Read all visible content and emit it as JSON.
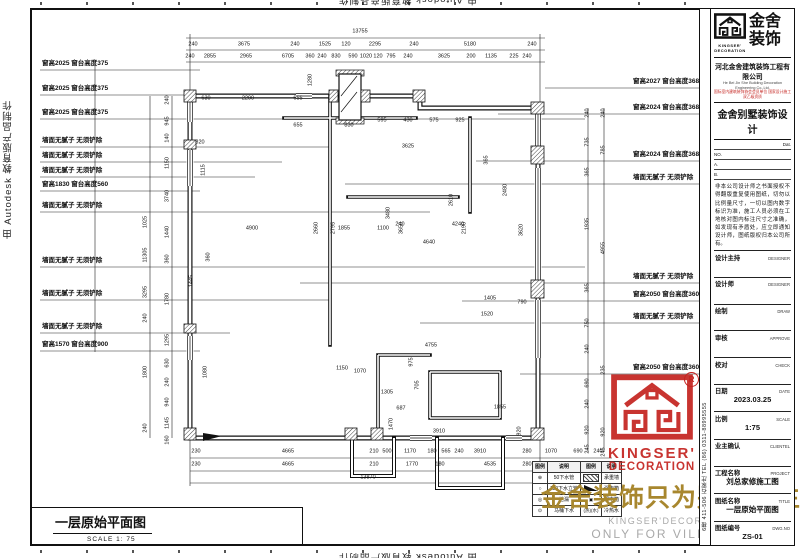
{
  "sheet": {
    "autodesk_side_text": "由 Autodesk 教育版产品制作",
    "autodesk_top_text": "由 Autodesk 教育版产品制作",
    "autodesk_bottom_text": "由 Autodesk 教育版产品制作"
  },
  "title_box": {
    "title": "一层原始平面图",
    "scale": "SCALE 1: 75"
  },
  "watermark": {
    "cn": "金舍装饰只为别墅而生。",
    "en1": "KINGSER'DECORATION",
    "en2": "ONLY FOR VILLA LIFE"
  },
  "stamp": {
    "brand1": "KINGSER'",
    "brand2": "DECORATION",
    "reg": "R"
  },
  "left_labels": [
    {
      "text": "窗高2025 窗台高度375",
      "y": 70,
      "to": 200
    },
    {
      "text": "窗高2025 窗台高度375",
      "y": 95,
      "to": 230
    },
    {
      "text": "窗高2025 窗台高度375",
      "y": 119,
      "to": 585
    },
    {
      "text": "墙面无腻子 无须铲除",
      "y": 147,
      "to": 330
    },
    {
      "text": "墙面无腻子 无须铲除",
      "y": 162,
      "to": 282
    },
    {
      "text": "墙面无腻子 无须铲除",
      "y": 177,
      "to": 255
    },
    {
      "text": "窗高1830 窗台高度560",
      "y": 191,
      "to": 200
    },
    {
      "text": "墙面无腻子 无须铲除",
      "y": 212,
      "to": 430
    },
    {
      "text": "墙面无腻子 无须铲除",
      "y": 267,
      "to": 585
    },
    {
      "text": "墙面无腻子 无须铲除",
      "y": 300,
      "to": 330
    },
    {
      "text": "墙面无腻子 无须铲除",
      "y": 333,
      "to": 230
    },
    {
      "text": "窗高1570 窗台高度900",
      "y": 351,
      "to": 200
    }
  ],
  "right_labels": [
    {
      "text": "窗高2027 窗台高度368",
      "y": 88,
      "from": 545
    },
    {
      "text": "窗高2024 窗台高度368",
      "y": 114,
      "from": 498
    },
    {
      "text": "窗高2024 窗台高度368",
      "y": 161,
      "from": 476
    },
    {
      "text": "墙面无腻子 无须铲除",
      "y": 184,
      "from": 345
    },
    {
      "text": "墙面无腻子 无须铲除",
      "y": 283,
      "from": 300
    },
    {
      "text": "窗高2050 窗台高度360",
      "y": 301,
      "from": 462
    },
    {
      "text": "墙面无腻子 无须铲除",
      "y": 323,
      "from": 420
    },
    {
      "text": "窗高2050 窗台高度360",
      "y": 374,
      "from": 520
    }
  ],
  "dims": {
    "top_total": [
      {
        "t": "13755",
        "x": 360,
        "y": 32
      }
    ],
    "top_row1": [
      {
        "t": "240",
        "x": 193,
        "y": 45
      },
      {
        "t": "3675",
        "x": 244,
        "y": 45
      },
      {
        "t": "240",
        "x": 295,
        "y": 45
      },
      {
        "t": "1525",
        "x": 325,
        "y": 45
      },
      {
        "t": "120",
        "x": 346,
        "y": 45
      },
      {
        "t": "2295",
        "x": 375,
        "y": 45
      },
      {
        "t": "240",
        "x": 414,
        "y": 45
      },
      {
        "t": "5180",
        "x": 470,
        "y": 45
      },
      {
        "t": "240",
        "x": 532,
        "y": 45
      }
    ],
    "top_row2": [
      {
        "t": "240",
        "x": 190,
        "y": 57
      },
      {
        "t": "2855",
        "x": 210,
        "y": 57
      },
      {
        "t": "2965",
        "x": 246,
        "y": 57
      },
      {
        "t": "6705",
        "x": 288,
        "y": 57
      },
      {
        "t": "360",
        "x": 310,
        "y": 57
      },
      {
        "t": "240",
        "x": 322,
        "y": 57
      },
      {
        "t": "830",
        "x": 336,
        "y": 57
      },
      {
        "t": "590",
        "x": 353,
        "y": 57
      },
      {
        "t": "1020",
        "x": 366,
        "y": 57
      },
      {
        "t": "120",
        "x": 378,
        "y": 57
      },
      {
        "t": "795",
        "x": 391,
        "y": 57
      },
      {
        "t": "240",
        "x": 408,
        "y": 57
      },
      {
        "t": "3625",
        "x": 444,
        "y": 57
      },
      {
        "t": "200",
        "x": 471,
        "y": 57
      },
      {
        "t": "1135",
        "x": 491,
        "y": 57
      },
      {
        "t": "225",
        "x": 514,
        "y": 57
      },
      {
        "t": "240",
        "x": 527,
        "y": 57
      }
    ],
    "bottom_row1": [
      {
        "t": "230",
        "x": 196,
        "y": 452
      },
      {
        "t": "4665",
        "x": 288,
        "y": 452
      },
      {
        "t": "210",
        "x": 374,
        "y": 452
      },
      {
        "t": "500",
        "x": 387,
        "y": 452
      },
      {
        "t": "1170",
        "x": 410,
        "y": 452
      },
      {
        "t": "180",
        "x": 432,
        "y": 452
      },
      {
        "t": "565",
        "x": 446,
        "y": 452
      },
      {
        "t": "240",
        "x": 459,
        "y": 452
      },
      {
        "t": "3910",
        "x": 480,
        "y": 452
      },
      {
        "t": "280",
        "x": 527,
        "y": 452
      },
      {
        "t": "1070",
        "x": 551,
        "y": 452
      },
      {
        "t": "690",
        "x": 578,
        "y": 452
      },
      {
        "t": "240",
        "x": 598,
        "y": 452
      }
    ],
    "bottom_row2": [
      {
        "t": "230",
        "x": 196,
        "y": 465
      },
      {
        "t": "4665",
        "x": 288,
        "y": 465
      },
      {
        "t": "210",
        "x": 374,
        "y": 465
      },
      {
        "t": "1770",
        "x": 412,
        "y": 465
      },
      {
        "t": "180",
        "x": 440,
        "y": 465
      },
      {
        "t": "4535",
        "x": 490,
        "y": 465
      },
      {
        "t": "280",
        "x": 527,
        "y": 465
      },
      {
        "t": "1760",
        "x": 553,
        "y": 465
      }
    ],
    "bottom_total": [
      {
        "t": "13870",
        "x": 368,
        "y": 478
      }
    ],
    "left_colA": [
      {
        "t": "1025",
        "x": 146,
        "y": 222,
        "v": 1
      },
      {
        "t": "11305",
        "x": 146,
        "y": 255,
        "v": 1
      },
      {
        "t": "3295",
        "x": 146,
        "y": 292,
        "v": 1
      },
      {
        "t": "240",
        "x": 146,
        "y": 318,
        "v": 1
      },
      {
        "t": "1800",
        "x": 146,
        "y": 372,
        "v": 1
      },
      {
        "t": "240",
        "x": 146,
        "y": 428,
        "v": 1
      }
    ],
    "left_colB": [
      {
        "t": "240",
        "x": 168,
        "y": 100,
        "v": 1
      },
      {
        "t": "945",
        "x": 168,
        "y": 121,
        "v": 1
      },
      {
        "t": "140",
        "x": 168,
        "y": 138,
        "v": 1
      },
      {
        "t": "1150",
        "x": 168,
        "y": 163,
        "v": 1
      },
      {
        "t": "3740",
        "x": 168,
        "y": 196,
        "v": 1
      },
      {
        "t": "1440",
        "x": 168,
        "y": 232,
        "v": 1
      },
      {
        "t": "360",
        "x": 168,
        "y": 259,
        "v": 1
      },
      {
        "t": "1780",
        "x": 168,
        "y": 299,
        "v": 1
      },
      {
        "t": "1295",
        "x": 168,
        "y": 340,
        "v": 1
      },
      {
        "t": "630",
        "x": 168,
        "y": 363,
        "v": 1
      },
      {
        "t": "240",
        "x": 168,
        "y": 382,
        "v": 1
      },
      {
        "t": "940",
        "x": 168,
        "y": 402,
        "v": 1
      },
      {
        "t": "1145",
        "x": 168,
        "y": 423,
        "v": 1
      },
      {
        "t": "160",
        "x": 168,
        "y": 440,
        "v": 1
      }
    ],
    "right_colA": [
      {
        "t": "240",
        "x": 588,
        "y": 113,
        "v": 1
      },
      {
        "t": "735",
        "x": 588,
        "y": 142,
        "v": 1
      },
      {
        "t": "365",
        "x": 588,
        "y": 172,
        "v": 1
      },
      {
        "t": "1935",
        "x": 588,
        "y": 224,
        "v": 1
      },
      {
        "t": "365",
        "x": 588,
        "y": 288,
        "v": 1
      },
      {
        "t": "750",
        "x": 588,
        "y": 323,
        "v": 1
      },
      {
        "t": "240",
        "x": 588,
        "y": 349,
        "v": 1
      },
      {
        "t": "690",
        "x": 588,
        "y": 383,
        "v": 1
      },
      {
        "t": "240",
        "x": 588,
        "y": 404,
        "v": 1
      },
      {
        "t": "920",
        "x": 588,
        "y": 430,
        "v": 1
      },
      {
        "t": "245",
        "x": 588,
        "y": 449,
        "v": 1
      }
    ],
    "right_colB": [
      {
        "t": "240",
        "x": 604,
        "y": 113,
        "v": 1
      },
      {
        "t": "785",
        "x": 604,
        "y": 150,
        "v": 1
      },
      {
        "t": "4955",
        "x": 604,
        "y": 248,
        "v": 1
      },
      {
        "t": "235",
        "x": 604,
        "y": 370,
        "v": 1
      },
      {
        "t": "920",
        "x": 604,
        "y": 432,
        "v": 1
      },
      {
        "t": "245",
        "x": 604,
        "y": 452,
        "v": 1
      }
    ],
    "plan": [
      {
        "t": "630",
        "x": 206,
        "y": 99
      },
      {
        "t": "2290",
        "x": 248,
        "y": 99
      },
      {
        "t": "655",
        "x": 298,
        "y": 99
      },
      {
        "t": "655",
        "x": 298,
        "y": 126
      },
      {
        "t": "830",
        "x": 349,
        "y": 126
      },
      {
        "t": "595",
        "x": 382,
        "y": 121
      },
      {
        "t": "430",
        "x": 408,
        "y": 121
      },
      {
        "t": "575",
        "x": 434,
        "y": 121
      },
      {
        "t": "925",
        "x": 460,
        "y": 121
      },
      {
        "t": "3625",
        "x": 408,
        "y": 147
      },
      {
        "t": "820",
        "x": 200,
        "y": 143
      },
      {
        "t": "1115",
        "x": 204,
        "y": 170,
        "v": 1
      },
      {
        "t": "1280",
        "x": 311,
        "y": 80,
        "v": 1
      },
      {
        "t": "2660",
        "x": 317,
        "y": 228,
        "v": 1
      },
      {
        "t": "2795",
        "x": 334,
        "y": 228,
        "v": 1
      },
      {
        "t": "3480",
        "x": 389,
        "y": 213,
        "v": 1
      },
      {
        "t": "3650",
        "x": 402,
        "y": 228,
        "v": 1
      },
      {
        "t": "2610",
        "x": 452,
        "y": 200,
        "v": 1
      },
      {
        "t": "2190",
        "x": 465,
        "y": 228,
        "v": 1
      },
      {
        "t": "2480",
        "x": 506,
        "y": 190,
        "v": 1
      },
      {
        "t": "3620",
        "x": 522,
        "y": 230,
        "v": 1
      },
      {
        "t": "365",
        "x": 487,
        "y": 160,
        "v": 1
      },
      {
        "t": "1445",
        "x": 192,
        "y": 281,
        "v": 1
      },
      {
        "t": "360",
        "x": 209,
        "y": 257,
        "v": 1
      },
      {
        "t": "1080",
        "x": 206,
        "y": 372,
        "v": 1
      },
      {
        "t": "4900",
        "x": 252,
        "y": 229
      },
      {
        "t": "1855",
        "x": 344,
        "y": 229
      },
      {
        "t": "1100",
        "x": 383,
        "y": 229
      },
      {
        "t": "240",
        "x": 400,
        "y": 225
      },
      {
        "t": "4240",
        "x": 458,
        "y": 225
      },
      {
        "t": "4640",
        "x": 429,
        "y": 243
      },
      {
        "t": "1405",
        "x": 490,
        "y": 299
      },
      {
        "t": "1520",
        "x": 487,
        "y": 315
      },
      {
        "t": "790",
        "x": 522,
        "y": 303
      },
      {
        "t": "975",
        "x": 412,
        "y": 362,
        "v": 1
      },
      {
        "t": "1150",
        "x": 342,
        "y": 369
      },
      {
        "t": "1070",
        "x": 360,
        "y": 372
      },
      {
        "t": "4755",
        "x": 431,
        "y": 346
      },
      {
        "t": "1305",
        "x": 387,
        "y": 393
      },
      {
        "t": "1470",
        "x": 392,
        "y": 424,
        "v": 1
      },
      {
        "t": "687",
        "x": 401,
        "y": 409
      },
      {
        "t": "3910",
        "x": 439,
        "y": 432
      },
      {
        "t": "920",
        "x": 520,
        "y": 431,
        "v": 1
      },
      {
        "t": "705",
        "x": 418,
        "y": 385,
        "v": 1
      },
      {
        "t": "1855",
        "x": 500,
        "y": 408
      }
    ]
  },
  "legend": {
    "headers": [
      "图例",
      "说明",
      "图例",
      "说明"
    ],
    "rows": [
      {
        "s": "⊕",
        "t": "50下水管",
        "k": "hatch",
        "s2": "",
        "t2": "承重墙"
      },
      {
        "s": "○",
        "t": "110下水立管",
        "k": "wedge",
        "s2": "",
        "t2": "强电箱"
      },
      {
        "s": "◎",
        "t": "地漏",
        "k": "text",
        "s2": "▣",
        "t2": "弱电箱"
      },
      {
        "s": "⊙",
        "t": "马桶下水",
        "k": "text",
        "s2": "(热)(水)",
        "t2": "冷热水"
      }
    ]
  },
  "titleblock": {
    "logo_cn1": "金舍",
    "logo_cn2": "装饰",
    "logo_en1": "KINGSER'",
    "logo_en2": "DECORATION",
    "company": "河北金舍建筑装饰工程有限公司",
    "company_en": "He Bei Jin She Building Decoration Engineering Co.,Ltd.",
    "company_sub": "国际室内建筑装饰协会会员单位 国家设计施工双乙级资质",
    "product": "金舍别墅装饰设计",
    "date_line": "Dat.",
    "no_line": "NO.",
    "a_line": "A.",
    "b_line": "B.",
    "disclaimer": "非本公司设计师之书面授权不得翻版重复使用图纸，切勿以比例量尺寸，一切以图内数字标识为准，施工人员必须在工地核对图内标注尺寸之准确，如发现有矛盾处，应立即通知设计师，图纸版权归本公司所有。",
    "address_strip": "6楼 411-506 石家庄 TEL (86) 0311-88995555",
    "fields": [
      {
        "label": "设计主持",
        "en": "DESIGNER",
        "value": ""
      },
      {
        "label": "设计师",
        "en": "DESIGNER",
        "value": ""
      },
      {
        "label": "绘制",
        "en": "DRAW",
        "value": ""
      },
      {
        "label": "审核",
        "en": "APPROVE",
        "value": ""
      },
      {
        "label": "校对",
        "en": "CHECK",
        "value": ""
      },
      {
        "label": "日期",
        "en": "DATE",
        "value": "2023.03.25"
      },
      {
        "label": "比例",
        "en": "SCALE",
        "value": "1:75"
      },
      {
        "label": "业主确认",
        "en": "CLIENTEL",
        "value": ""
      },
      {
        "label": "工程名称",
        "en": "PROJECT",
        "value": "刘总家修施工图"
      },
      {
        "label": "图纸名称",
        "en": "TITLE",
        "value": "一层原始平面图"
      },
      {
        "label": "图纸编号",
        "en": "DWG.NO",
        "value": "ZS-01"
      }
    ]
  }
}
